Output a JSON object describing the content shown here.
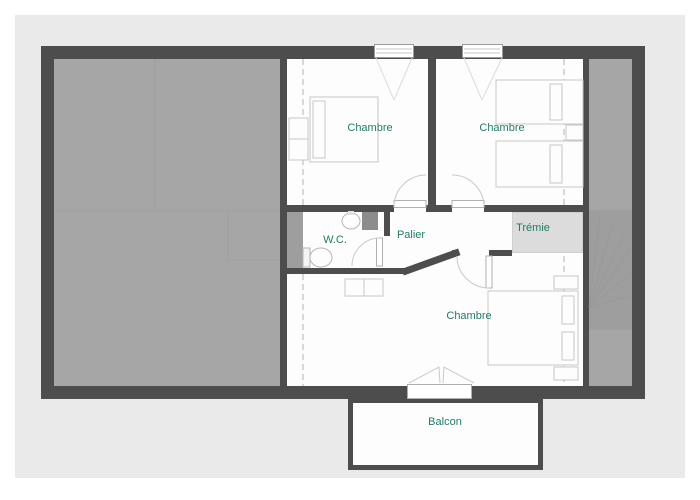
{
  "rooms": {
    "chambre1": "Chambre",
    "chambre2": "Chambre",
    "chambre3": "Chambre",
    "wc": "W.C.",
    "palier": "Palier",
    "tremie": "Trémie",
    "balcon": "Balcon"
  },
  "colors": {
    "wall": "#4d4d4d",
    "attic": "#a6a6a6",
    "panel": "#eaeaea",
    "room": "#fdfdfd",
    "label": "#237a66",
    "tremie": "#dcdcdc",
    "duct": "#8c8c8c",
    "block": "#9e9e9e"
  }
}
